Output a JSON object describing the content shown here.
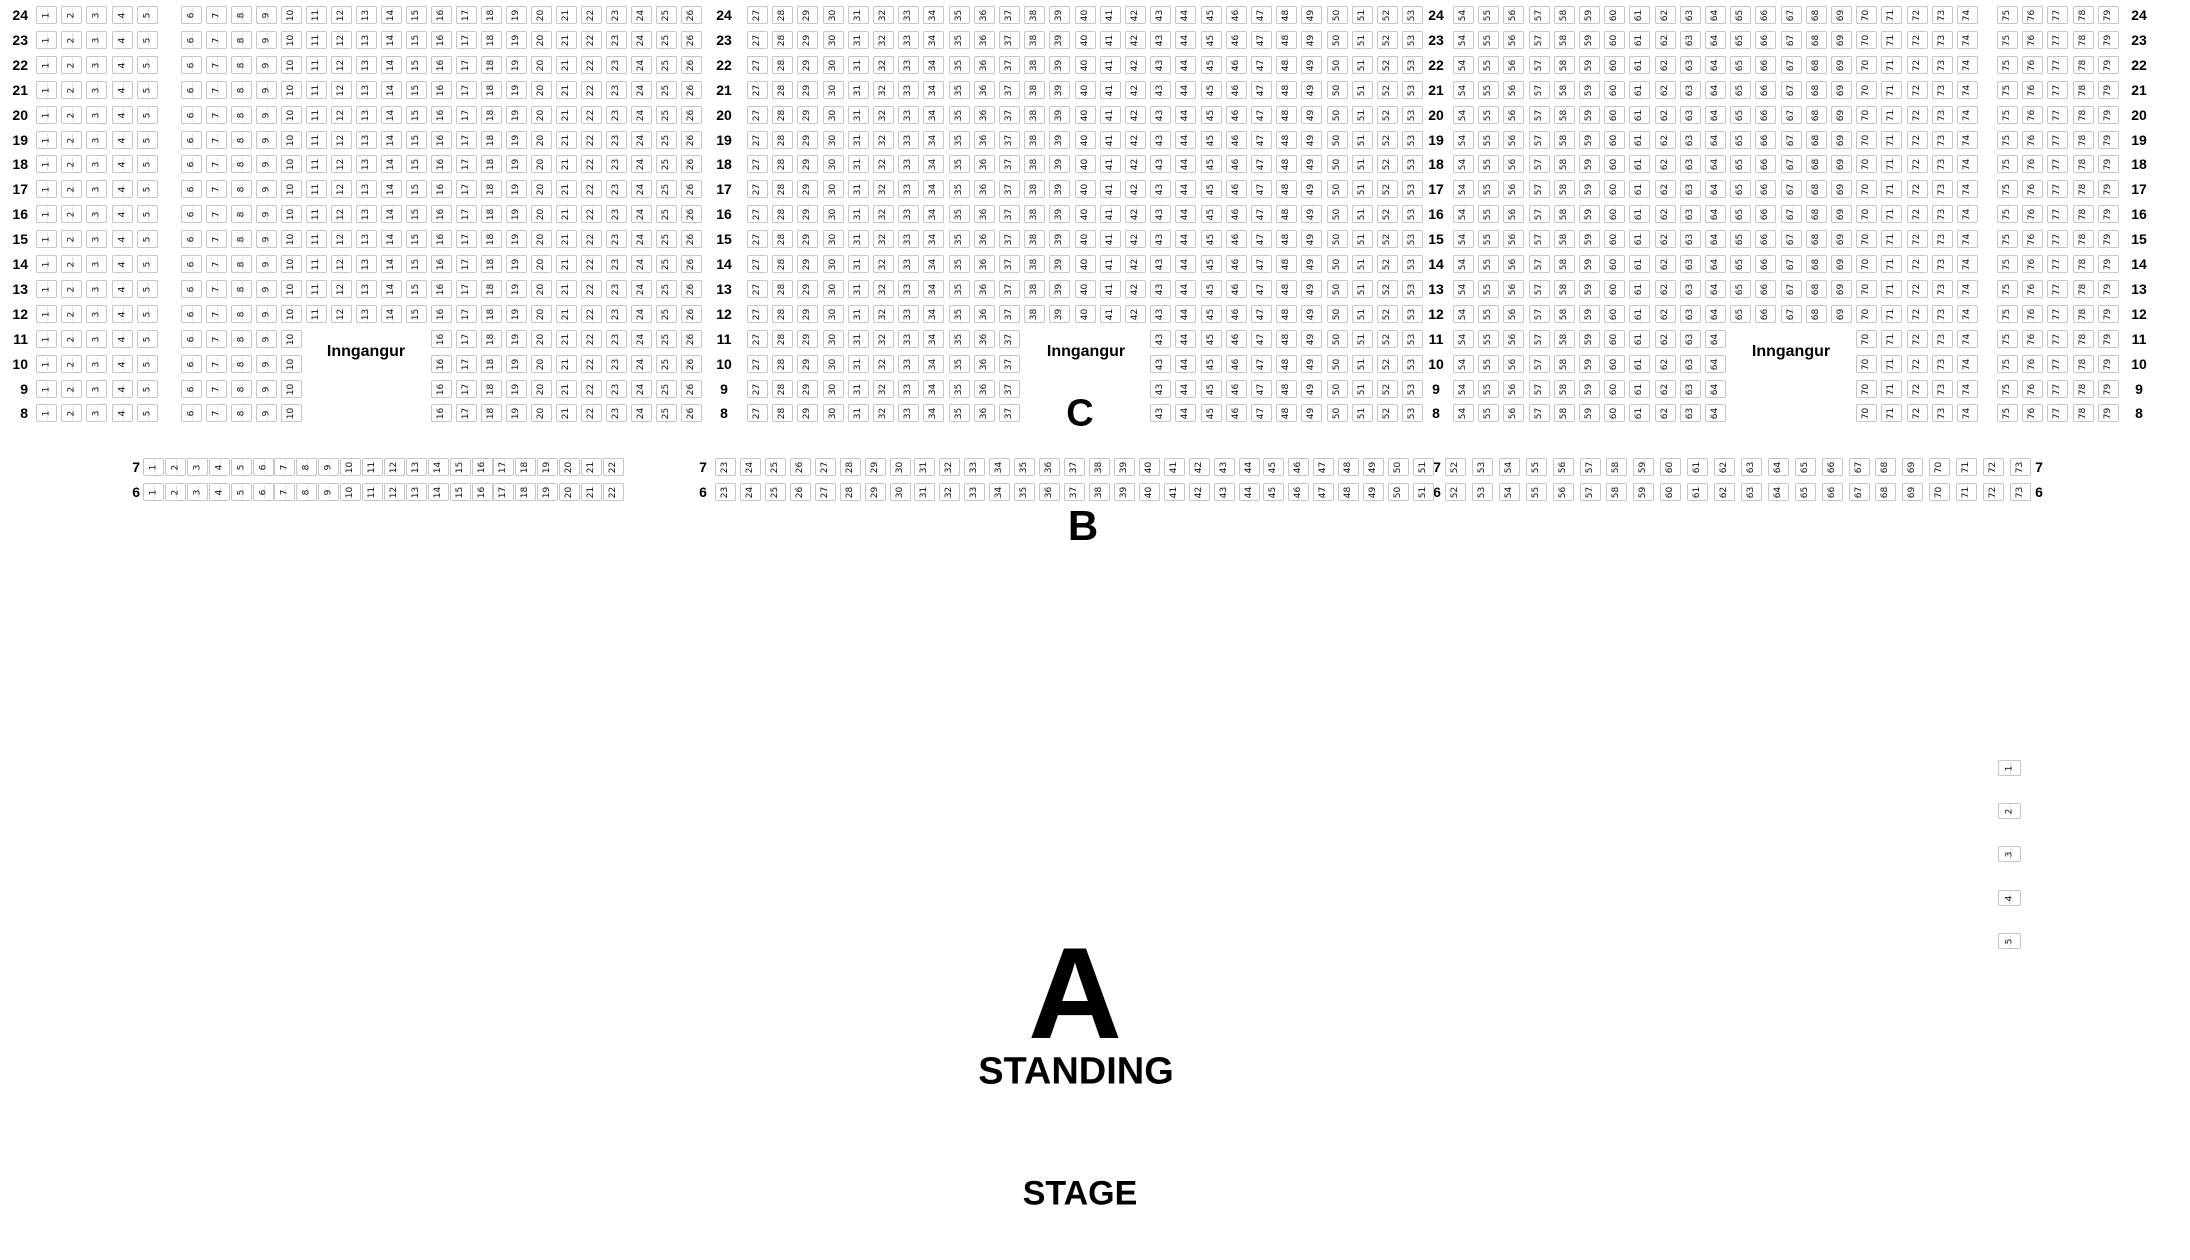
{
  "sections": {
    "A": {
      "label": "A",
      "type_label": "STANDING"
    },
    "B": {
      "label": "B",
      "rows": [
        7,
        6
      ],
      "seats_per_row": {
        "first": 1,
        "last": 73
      },
      "row_label_repeats_after_seats": [
        22,
        51
      ]
    },
    "C": {
      "label": "C",
      "rows": [
        24,
        23,
        22,
        21,
        20,
        19,
        18,
        17,
        16,
        15,
        14,
        13,
        12,
        11,
        10,
        9,
        8
      ],
      "seats_per_row": {
        "first": 1,
        "last": 79
      },
      "row_label_repeats_after_seats": [
        26,
        53
      ],
      "aisle_after_seats": [
        5,
        74
      ],
      "entrance_rows": [
        11,
        10,
        9,
        8
      ],
      "entrance_seat_gaps": [
        [
          11,
          15
        ],
        [
          38,
          42
        ],
        [
          65,
          69
        ]
      ]
    }
  },
  "entrances": [
    {
      "label": "Inngangur",
      "position": "left"
    },
    {
      "label": "Inngangur",
      "position": "center"
    },
    {
      "label": "Inngangur",
      "position": "right"
    }
  ],
  "side_seats": [
    1,
    2,
    3,
    4,
    5
  ],
  "stage": {
    "label": "STAGE"
  },
  "colors": {
    "background": "#ffffff",
    "seat_border": "#c6c6c6",
    "text": "#000000"
  }
}
